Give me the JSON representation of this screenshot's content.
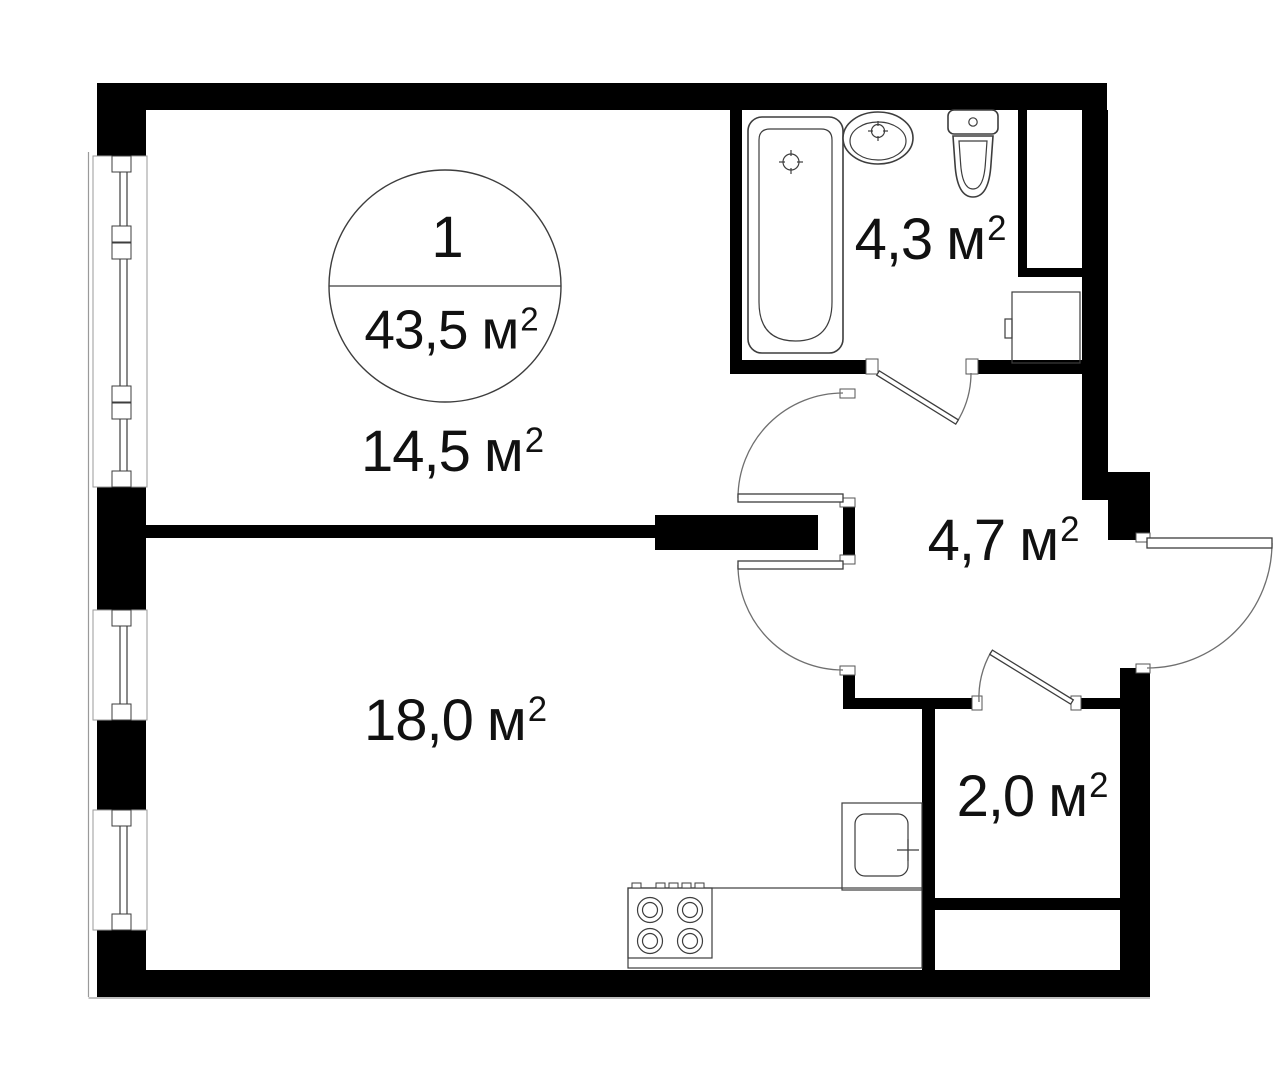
{
  "plan_badge": {
    "room_count": "1",
    "total_area": "43,5"
  },
  "unit": {
    "base": "м",
    "sup": "2"
  },
  "rooms": [
    {
      "key": "living-room",
      "area": "14,5"
    },
    {
      "key": "kitchen",
      "area": "18,0"
    },
    {
      "key": "bathroom",
      "area": "4,3"
    },
    {
      "key": "hallway",
      "area": "4,7"
    },
    {
      "key": "storage",
      "area": "2,0"
    }
  ],
  "colors": {
    "wall": "#000000",
    "fixture_line": "#3d3d3d",
    "arc_line": "#6f6f6f",
    "face_line": "#9a9a9a",
    "background": "#ffffff",
    "text": "#111111"
  }
}
